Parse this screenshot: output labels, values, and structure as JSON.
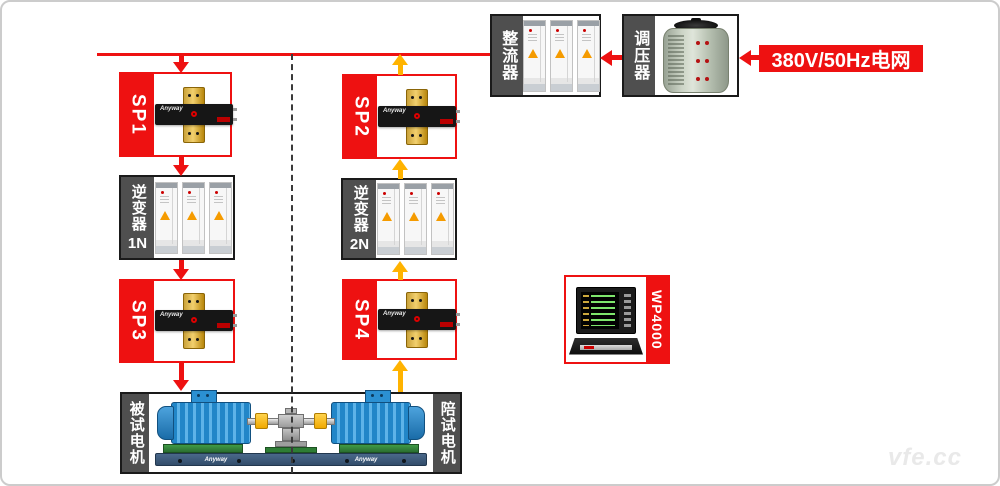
{
  "meta": {
    "watermark": "vfe.cc",
    "brand": "Anyway"
  },
  "grid": {
    "label": "380V/50Hz电网"
  },
  "nodes": {
    "sp1": {
      "label": "SP1"
    },
    "sp2": {
      "label": "SP2"
    },
    "sp3": {
      "label": "SP3"
    },
    "sp4": {
      "label": "SP4"
    },
    "inverter1": {
      "label": "逆变器",
      "sub": "1N"
    },
    "inverter2": {
      "label": "逆变器",
      "sub": "2N"
    },
    "rectifier": {
      "label": "整流器"
    },
    "regulator": {
      "label": "调压器"
    },
    "analyzer": {
      "label": "WP4000"
    },
    "motor_left": {
      "label": "被试电机"
    },
    "motor_right": {
      "label": "陪试电机"
    }
  },
  "flows": [
    {
      "from": "grid",
      "to": "regulator",
      "color": "red"
    },
    {
      "from": "regulator",
      "to": "rectifier",
      "color": "red"
    },
    {
      "from": "bus",
      "to": "sp1",
      "color": "red"
    },
    {
      "from": "sp1",
      "to": "inverter1",
      "color": "red"
    },
    {
      "from": "inverter1",
      "to": "sp3",
      "color": "red"
    },
    {
      "from": "sp3",
      "to": "motor_left",
      "color": "red"
    },
    {
      "from": "motor_right",
      "to": "sp4",
      "color": "yellow"
    },
    {
      "from": "sp4",
      "to": "inverter2",
      "color": "yellow"
    },
    {
      "from": "inverter2",
      "to": "sp2",
      "color": "yellow"
    },
    {
      "from": "sp2",
      "to": "bus",
      "color": "yellow"
    }
  ],
  "colors": {
    "red": "#ee1111",
    "yellow": "#ffb300",
    "label_bg": "#4f4f4f",
    "motor_blue": "#2186c8"
  }
}
